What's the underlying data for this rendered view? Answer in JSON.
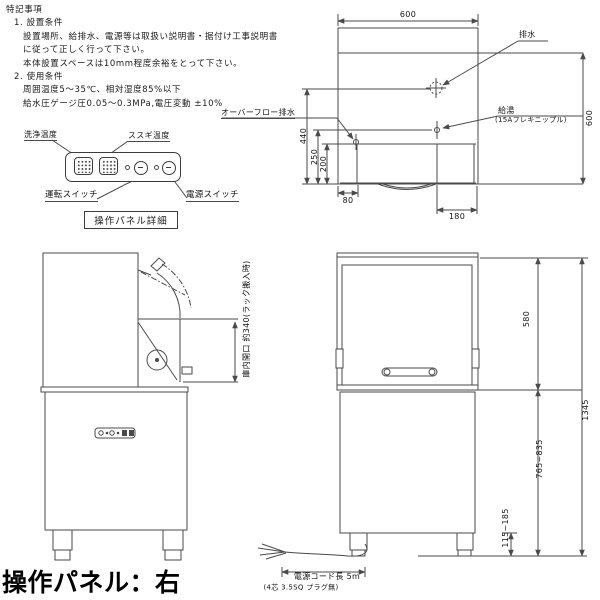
{
  "meta": {
    "background": "#ffffff",
    "line_color": "#4a4a4a",
    "text_color": "#111111"
  },
  "notes": {
    "title": "特記事項",
    "lines": [
      "1. 設置条件",
      "設置場所、給排水、電源等は取扱い説明書・据付け工事説明書",
      "に従って正しく行って下さい。",
      "本体設置スペースは10mm程度余裕をとって下さい。",
      "2. 使用条件",
      "周囲温度5～35℃、相対湿度85%以下",
      "給水圧ゲージ圧0.05～0.3MPa,電圧変動 ±10%"
    ]
  },
  "panel_detail": {
    "wash_temp_label": "洗浄温度",
    "rinse_temp_label": "ススギ温度",
    "run_switch_label": "運転スイッチ",
    "power_switch_label": "電源スイッチ",
    "title": "操作パネル詳細"
  },
  "plan_view": {
    "dim_top_width": "600",
    "dim_right_depth": "600",
    "dim_drain": "440",
    "dim_supply": "250",
    "dim_overflow": "200",
    "dim_left_offset": "80",
    "dim_right_offset": "180",
    "drain_label": "排水",
    "supply_label": "給湯",
    "supply_note": "(15Aフレキニップル)",
    "overflow_label": "オーバーフロー排水"
  },
  "side_view": {
    "opening_label": "庫内開口 約340(ラック搬入時)"
  },
  "front_view": {
    "dim_hood_height": "580",
    "dim_total_height": "1345",
    "dim_body_height": "765~835",
    "dim_leg_height": "115~185"
  },
  "cord": {
    "length_label": "電源コード長 5m",
    "spec_label": "(4芯 3.5SQ プラグ無)"
  },
  "footer": {
    "label": "操作パネル：右"
  }
}
